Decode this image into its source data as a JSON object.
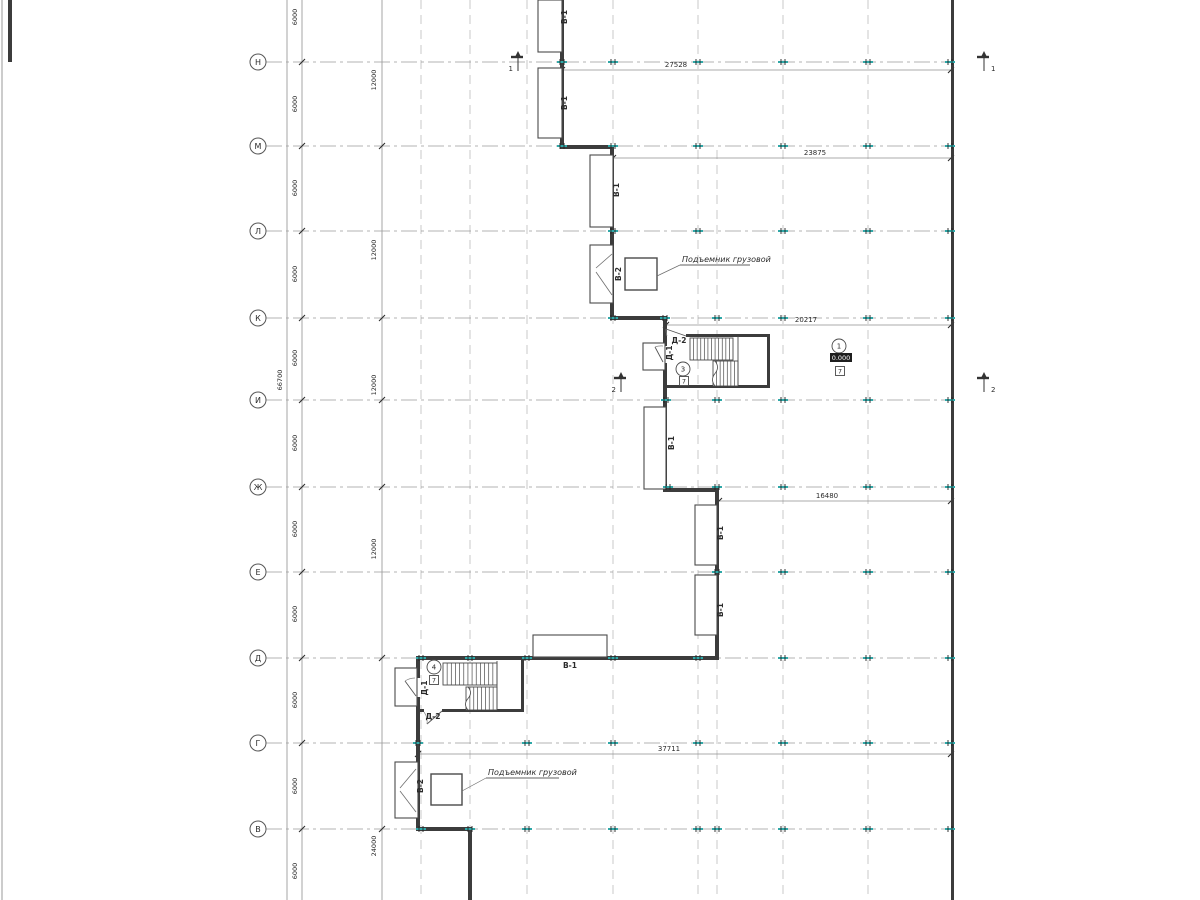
{
  "colors": {
    "ink": "#2b2b2b",
    "wall": "#3c3c3c",
    "grid": "#bdbdbd",
    "axis": "#9a9a9a",
    "dim": "#8f8f8f",
    "teal": "#2fa8a8",
    "white": "#ffffff",
    "thin": "#6e6e6e"
  },
  "canvas": {
    "w": 1200,
    "h": 900
  },
  "frame": {
    "edge_x": 2
  },
  "axes": {
    "circle_x": 258,
    "radius": 8,
    "line_x1": 266,
    "line_x2": 951,
    "rows": [
      {
        "label": "Н",
        "y": 62
      },
      {
        "label": "М",
        "y": 146
      },
      {
        "label": "Л",
        "y": 231
      },
      {
        "label": "К",
        "y": 318
      },
      {
        "label": "И",
        "y": 400
      },
      {
        "label": "Ж",
        "y": 487
      },
      {
        "label": "Е",
        "y": 572
      },
      {
        "label": "Д",
        "y": 658
      },
      {
        "label": "Г",
        "y": 743
      },
      {
        "label": "В",
        "y": 829
      }
    ]
  },
  "grid": {
    "vertical_dashed": [
      {
        "x": 421,
        "y1": 0
      },
      {
        "x": 470,
        "y1": 0
      },
      {
        "x": 527,
        "y1": 0
      },
      {
        "x": 613,
        "y1": 0
      },
      {
        "x": 698,
        "y1": 0
      },
      {
        "x": 717,
        "y1": 150
      },
      {
        "x": 783,
        "y1": 0
      },
      {
        "x": 868,
        "y1": 0
      }
    ],
    "vertical_solid": [
      287,
      302,
      382
    ]
  },
  "dims_left": {
    "total": {
      "label": "66700",
      "x": 282,
      "y": 380
    },
    "chain6000": {
      "text_x": 297,
      "slash_x": 302,
      "labels": [
        {
          "t": "6000",
          "y": 17
        },
        {
          "t": "6000",
          "y": 104
        },
        {
          "t": "6000",
          "y": 188
        },
        {
          "t": "6000",
          "y": 274
        },
        {
          "t": "6000",
          "y": 358
        },
        {
          "t": "6000",
          "y": 443
        },
        {
          "t": "6000",
          "y": 529
        },
        {
          "t": "6000",
          "y": 614
        },
        {
          "t": "6000",
          "y": 700
        },
        {
          "t": "6000",
          "y": 786
        },
        {
          "t": "6000",
          "y": 871
        }
      ]
    },
    "chain12000": {
      "text_x": 376,
      "slash_x": 382,
      "slash_ys": [
        146,
        318,
        400,
        487,
        658,
        829
      ],
      "labels": [
        {
          "t": "12000",
          "y": 80
        },
        {
          "t": "12000",
          "y": 250
        },
        {
          "t": "12000",
          "y": 385
        },
        {
          "t": "12000",
          "y": 549
        },
        {
          "t": "24000",
          "y": 846
        }
      ]
    }
  },
  "dims_horizontal": [
    {
      "label": "27528",
      "x1": 562,
      "x2": 951,
      "y": 70,
      "tx": 676
    },
    {
      "label": "23875",
      "x1": 613,
      "x2": 951,
      "y": 158,
      "tx": 815
    },
    {
      "label": "20217",
      "x1": 666,
      "x2": 951,
      "y": 325,
      "tx": 806
    },
    {
      "label": "16480",
      "x1": 719,
      "x2": 951,
      "y": 501,
      "tx": 827
    },
    {
      "label": "37711",
      "x1": 418,
      "x2": 951,
      "y": 754,
      "tx": 669
    }
  ],
  "walls": [
    [
      8,
      0,
      4,
      62
    ],
    [
      560,
      0,
      4,
      149
    ],
    [
      560,
      145,
      53,
      4
    ],
    [
      610,
      145,
      4,
      175
    ],
    [
      610,
      316,
      57,
      4
    ],
    [
      663,
      316,
      4,
      176
    ],
    [
      663,
      488,
      56,
      4
    ],
    [
      715,
      488,
      4,
      172
    ],
    [
      416,
      656,
      303,
      4
    ],
    [
      416,
      656,
      4,
      175
    ],
    [
      416,
      827,
      56,
      4
    ],
    [
      468,
      827,
      4,
      73
    ],
    [
      951,
      0,
      3,
      900
    ],
    [
      686,
      334,
      84,
      3
    ],
    [
      767,
      334,
      3,
      54
    ],
    [
      665,
      385,
      105,
      3
    ],
    [
      521,
      658,
      3,
      54
    ],
    [
      416,
      709,
      108,
      3
    ]
  ],
  "door_gaps": [
    [
      662,
      346,
      6,
      17
    ],
    [
      415,
      678,
      6,
      19
    ],
    [
      424,
      708,
      18,
      5
    ]
  ],
  "door_leaves": [
    [
      686,
      336,
      666,
      329
    ],
    [
      663,
      362,
      655,
      347
    ],
    [
      416,
      696,
      405,
      681
    ],
    [
      442,
      711,
      427,
      724
    ]
  ],
  "door_arcs": [
    "M655,347 A18,18 0 0 1 663,346",
    "M666,329 A21,21 0 0 0 667,336",
    "M405,681 A19,19 0 0 1 415,678",
    "M427,724 A16,16 0 0 0 424,712"
  ],
  "bumps": [
    [
      538,
      0,
      24,
      52
    ],
    [
      538,
      68,
      24,
      70
    ],
    [
      590,
      155,
      23,
      72
    ],
    [
      590,
      245,
      23,
      58
    ],
    [
      644,
      407,
      22,
      82
    ],
    [
      695,
      505,
      22,
      60
    ],
    [
      695,
      575,
      22,
      60
    ],
    [
      533,
      635,
      74,
      22
    ],
    [
      643,
      343,
      22,
      27
    ],
    [
      395,
      668,
      22,
      38
    ],
    [
      395,
      762,
      23,
      56
    ]
  ],
  "bump_diagonals": [
    [
      596,
      268,
      612,
      254
    ],
    [
      596,
      272,
      612,
      295
    ],
    [
      400,
      788,
      416,
      769
    ],
    [
      400,
      791,
      416,
      812
    ]
  ],
  "lift_shafts": [
    [
      625,
      258,
      32,
      32
    ],
    [
      431,
      774,
      31,
      31
    ]
  ],
  "lift_notes": [
    {
      "text": "Подъемник грузовой",
      "tx": 682,
      "ty": 262,
      "ux1": 680,
      "uy": 265,
      "ux2": 750,
      "lx2": 657,
      "ly2": 276
    },
    {
      "text": "Подъемник грузовой",
      "tx": 488,
      "ty": 775,
      "ux1": 486,
      "uy": 778,
      "ux2": 559,
      "lx2": 462,
      "ly2": 791
    }
  ],
  "stairs": [
    {
      "flights": [
        {
          "x": 690,
          "y": 338,
          "w": 43,
          "h": 22,
          "n": 12
        },
        {
          "x": 713,
          "y": 361,
          "w": 25,
          "h": 25,
          "n": 7,
          "brk": true
        }
      ],
      "div": [
        738,
        336,
        738,
        385
      ]
    },
    {
      "flights": [
        {
          "x": 443,
          "y": 663,
          "w": 54,
          "h": 22,
          "n": 13
        },
        {
          "x": 466,
          "y": 687,
          "w": 31,
          "h": 23,
          "n": 8,
          "brk": true
        }
      ],
      "div": [
        497,
        661,
        497,
        709
      ]
    }
  ],
  "column_marker_rows": [
    {
      "y": 62,
      "xs": [
        562,
        613,
        698,
        783,
        868,
        950
      ]
    },
    {
      "y": 146,
      "xs": [
        562,
        613,
        698,
        783,
        868,
        950
      ]
    },
    {
      "y": 231,
      "xs": [
        613,
        698,
        783,
        868,
        950
      ]
    },
    {
      "y": 318,
      "xs": [
        613,
        665,
        717,
        783,
        868,
        950
      ]
    },
    {
      "y": 400,
      "xs": [
        666,
        717,
        783,
        868,
        950
      ]
    },
    {
      "y": 487,
      "xs": [
        668,
        717,
        783,
        868,
        950
      ]
    },
    {
      "y": 572,
      "xs": [
        717,
        783,
        868,
        950
      ]
    },
    {
      "y": 658,
      "xs": [
        421,
        470,
        527,
        613,
        698,
        783,
        868,
        950
      ]
    },
    {
      "y": 743,
      "xs": [
        418,
        527,
        613,
        698,
        783,
        868,
        950
      ]
    },
    {
      "y": 829,
      "xs": [
        421,
        470,
        527,
        613,
        698,
        717,
        783,
        868,
        950
      ]
    }
  ],
  "opening_labels": [
    {
      "t": "В-1",
      "x": 567,
      "y": 17,
      "rot": true
    },
    {
      "t": "В-1",
      "x": 567,
      "y": 103,
      "rot": true
    },
    {
      "t": "В-1",
      "x": 619,
      "y": 190,
      "rot": true
    },
    {
      "t": "В-2",
      "x": 621,
      "y": 274,
      "rot": true
    },
    {
      "t": "Д-2",
      "x": 679,
      "y": 343,
      "rot": false
    },
    {
      "t": "Д-1",
      "x": 672,
      "y": 353,
      "rot": true
    },
    {
      "t": "В-1",
      "x": 674,
      "y": 443,
      "rot": true
    },
    {
      "t": "В-1",
      "x": 723,
      "y": 533,
      "rot": true
    },
    {
      "t": "В-1",
      "x": 723,
      "y": 610,
      "rot": true
    },
    {
      "t": "В-1",
      "x": 570,
      "y": 668,
      "rot": false
    },
    {
      "t": "Д-1",
      "x": 427,
      "y": 688,
      "rot": true
    },
    {
      "t": "Д-2",
      "x": 433,
      "y": 719,
      "rot": false
    },
    {
      "t": "В-2",
      "x": 423,
      "y": 786,
      "rot": true
    }
  ],
  "room_circles": [
    {
      "t": "3",
      "x": 683,
      "y": 369
    },
    {
      "t": "1",
      "x": 839,
      "y": 346
    },
    {
      "t": "4",
      "x": 434,
      "y": 667
    }
  ],
  "type_squares": [
    {
      "t": "7",
      "x": 684,
      "y": 381
    },
    {
      "t": "7",
      "x": 840,
      "y": 371
    },
    {
      "t": "7",
      "x": 434,
      "y": 680
    }
  ],
  "elevation_mark": {
    "t": "0.000",
    "x": 841,
    "y": 358
  },
  "section_marks": [
    {
      "t": "1",
      "x": 519,
      "y": 62,
      "side": "left"
    },
    {
      "t": "1",
      "x": 985,
      "y": 62,
      "side": "right"
    },
    {
      "t": "2",
      "x": 622,
      "y": 383,
      "side": "left"
    },
    {
      "t": "2",
      "x": 985,
      "y": 383,
      "side": "right"
    }
  ]
}
